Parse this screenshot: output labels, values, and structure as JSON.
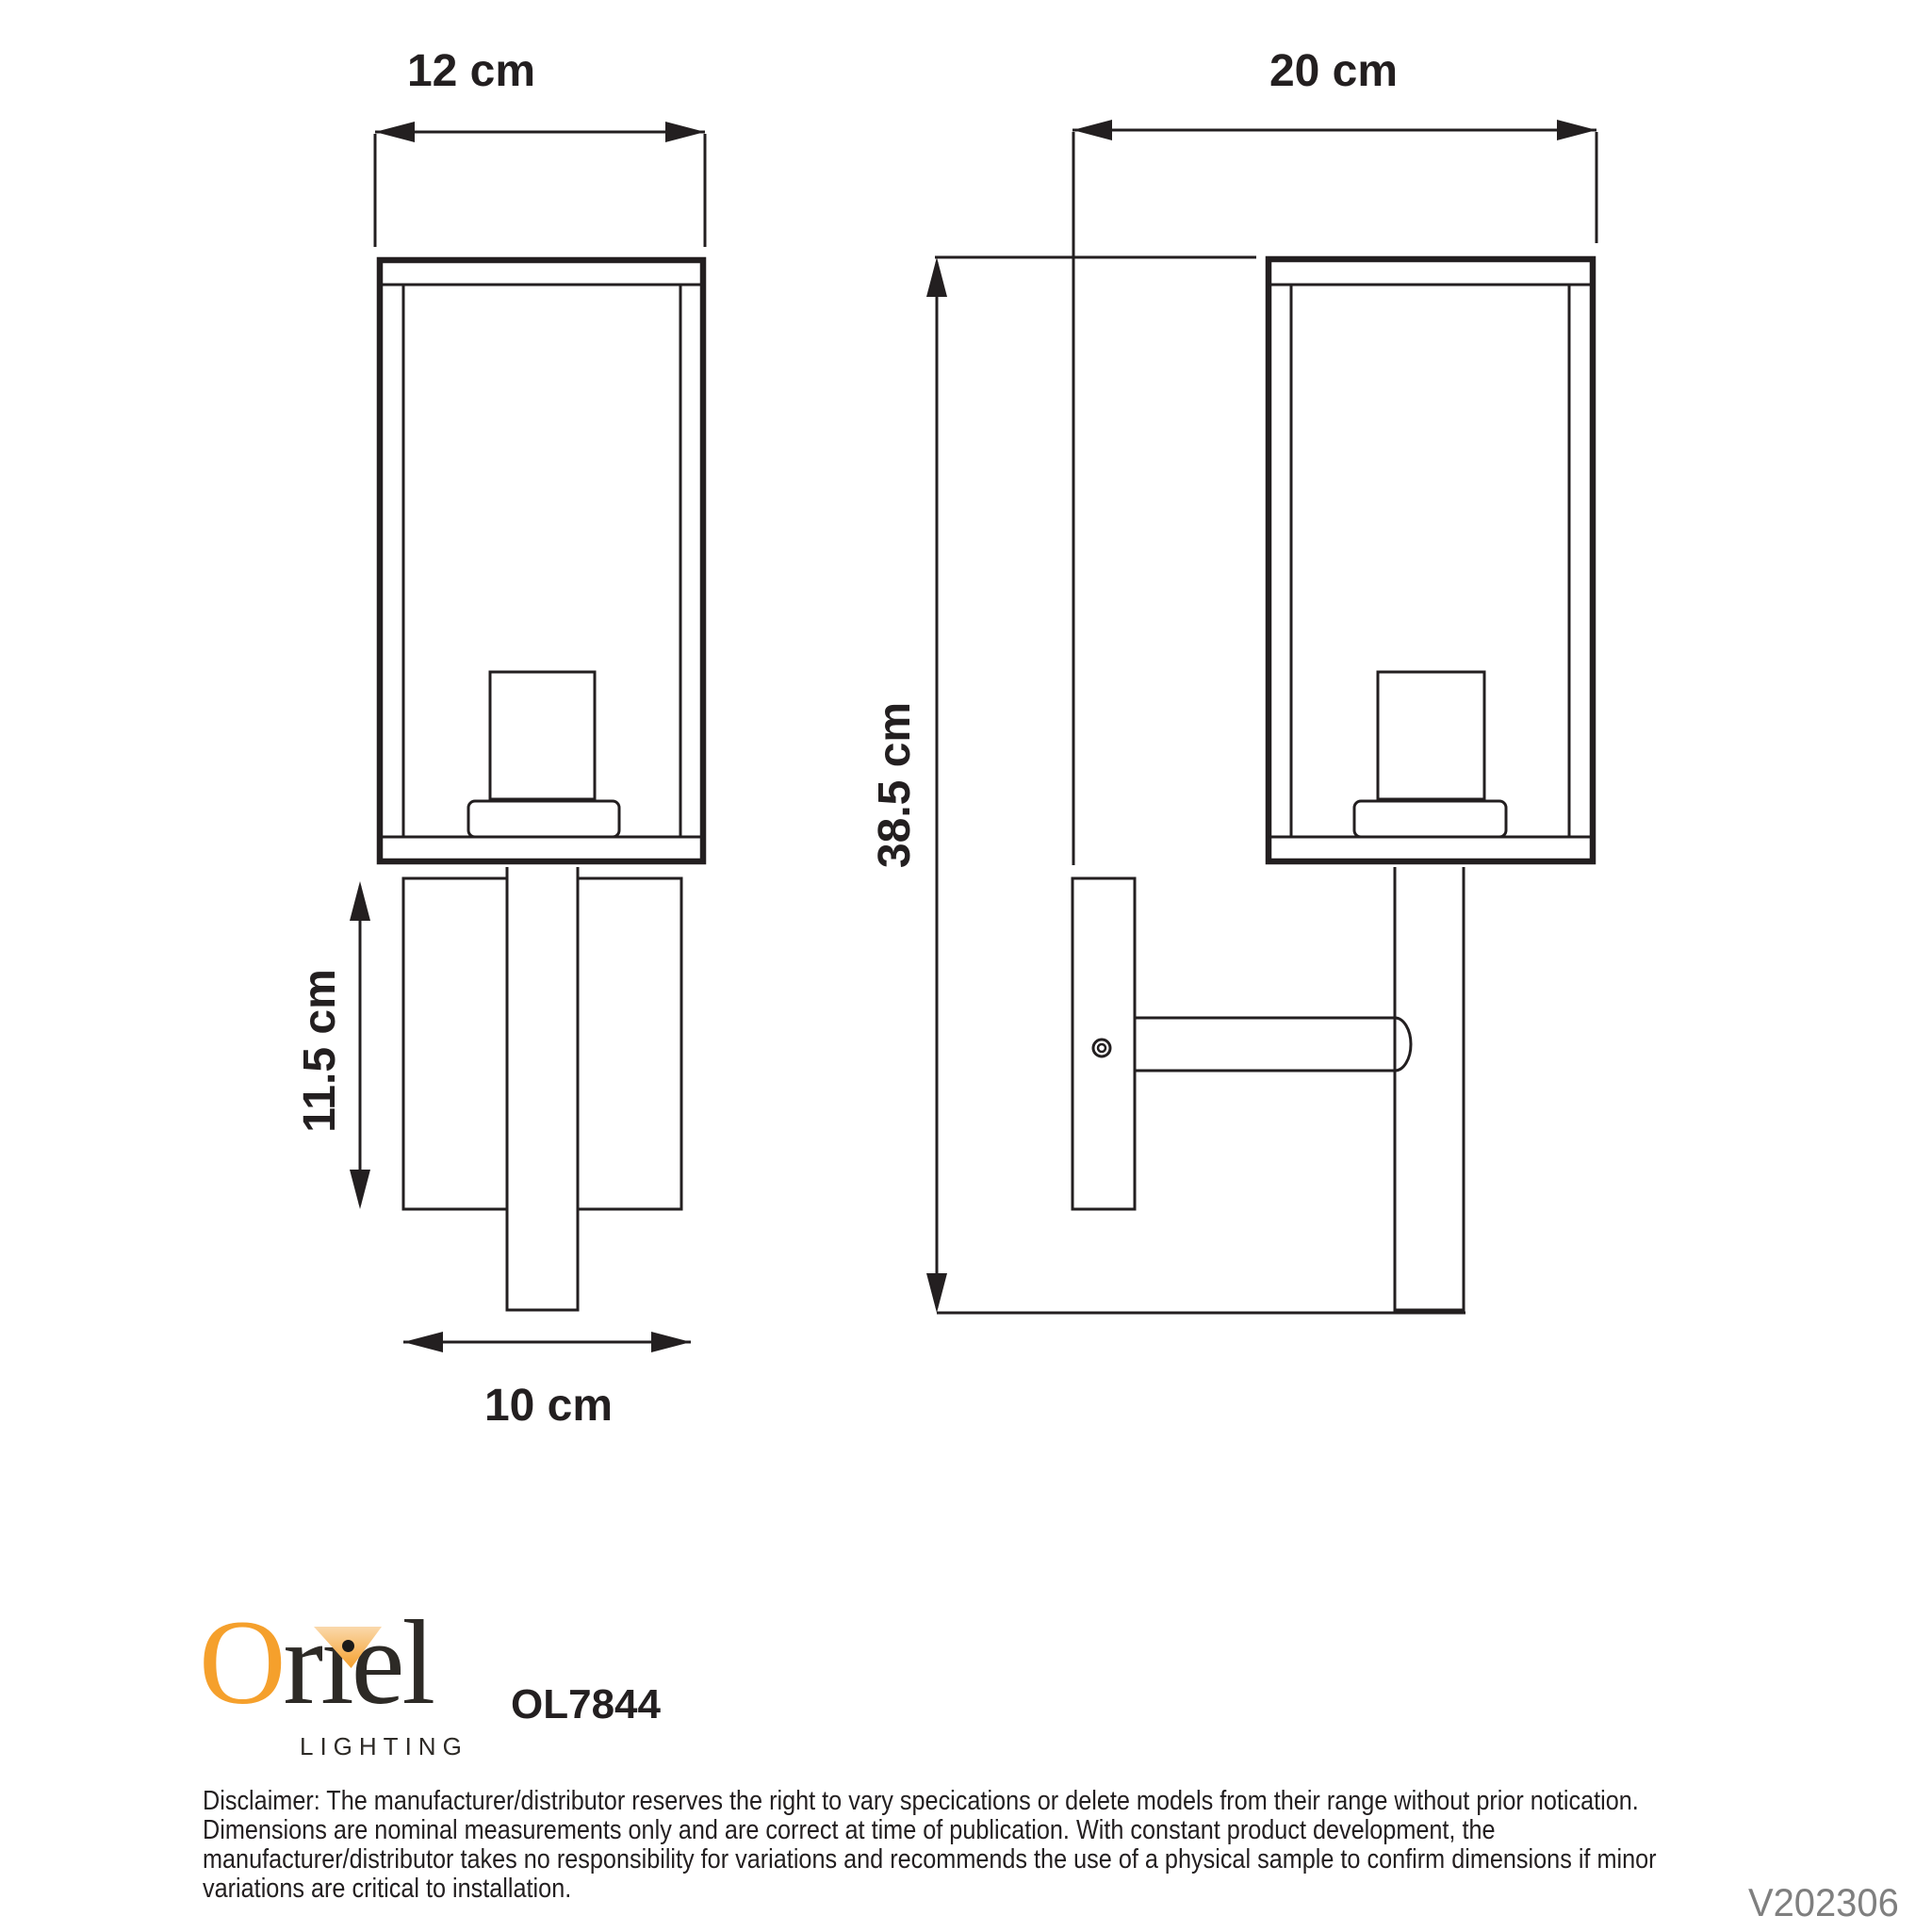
{
  "diagram": {
    "front_view": {
      "width_label": "12 cm",
      "plate_height_label": "11.5 cm",
      "plate_width_label": "10 cm"
    },
    "side_view": {
      "depth_label": "20 cm",
      "height_label": "38.5 cm"
    }
  },
  "branding": {
    "wordmark": {
      "o": "O",
      "r": "r",
      "dotless_i": "ı",
      "el": "el"
    },
    "tagline": "LIGHTING",
    "model_number": "OL7844",
    "brand_orange": "#F5A02C",
    "text_dark": "#2D2A26"
  },
  "footer": {
    "disclaimer_lines": [
      "Disclaimer: The manufacturer/distributor reserves the right to vary specications or delete models from their range without prior notication.",
      "Dimensions are nominal measurements only and are correct at time of publication. With constant product development, the",
      "manufacturer/distributor takes no responsibility for variations and recommends the use of a physical sample to confirm dimensions if minor",
      "variations are critical to installation."
    ],
    "version_code": "V202306",
    "version_color": "#7F7F7F"
  },
  "line_color": "#231F20"
}
